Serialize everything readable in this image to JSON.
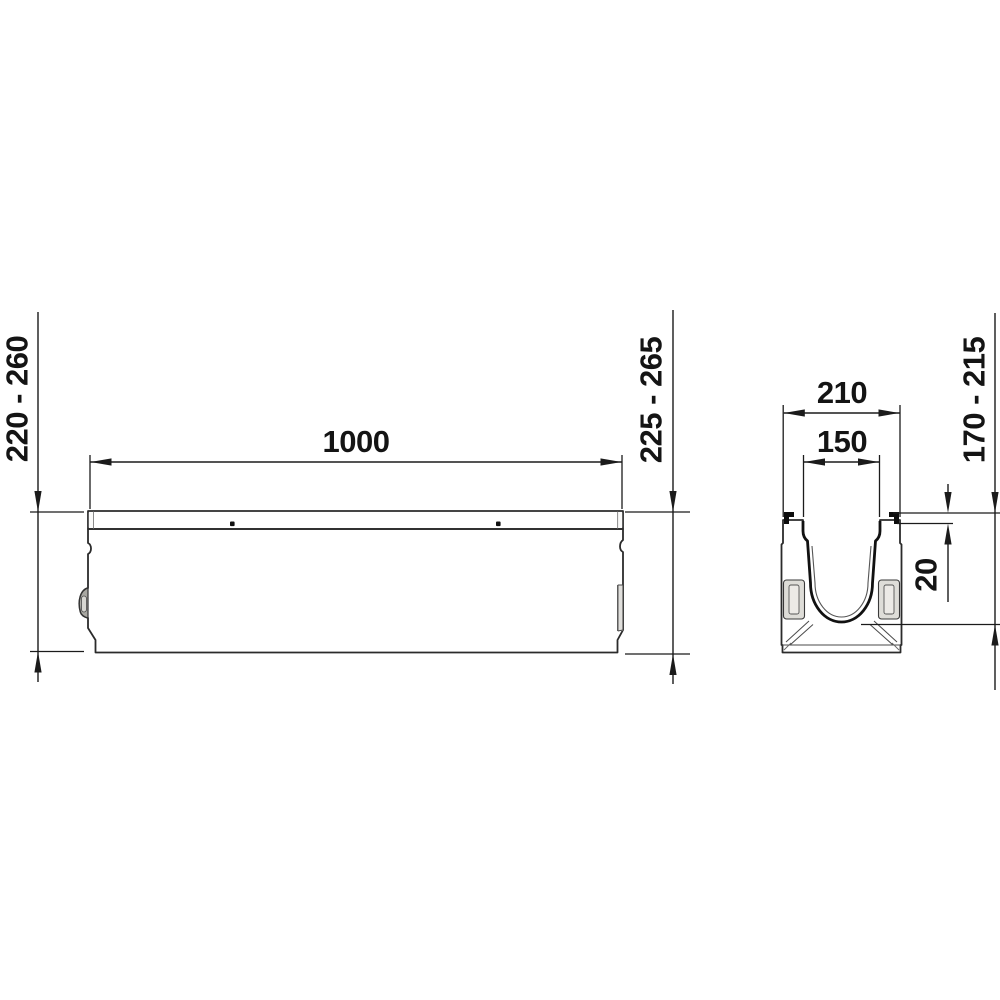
{
  "drawing": {
    "title": "drainage-channel-dimension-drawing",
    "side_view": {
      "length_dim": "1000",
      "left_height_dim": "220 - 260",
      "right_height_dim": "225 - 265"
    },
    "cross_section": {
      "outer_width_dim": "210",
      "inner_width_dim": "150",
      "edge_offset_dim": "20",
      "inner_depth_dim": "170 - 215"
    },
    "colors": {
      "background": "#ffffff",
      "line": "#1b1b1b",
      "concrete": "#e8e7e2",
      "edge_strip": "#f1f0ee",
      "steel_edge": "#0d0d0d"
    }
  }
}
